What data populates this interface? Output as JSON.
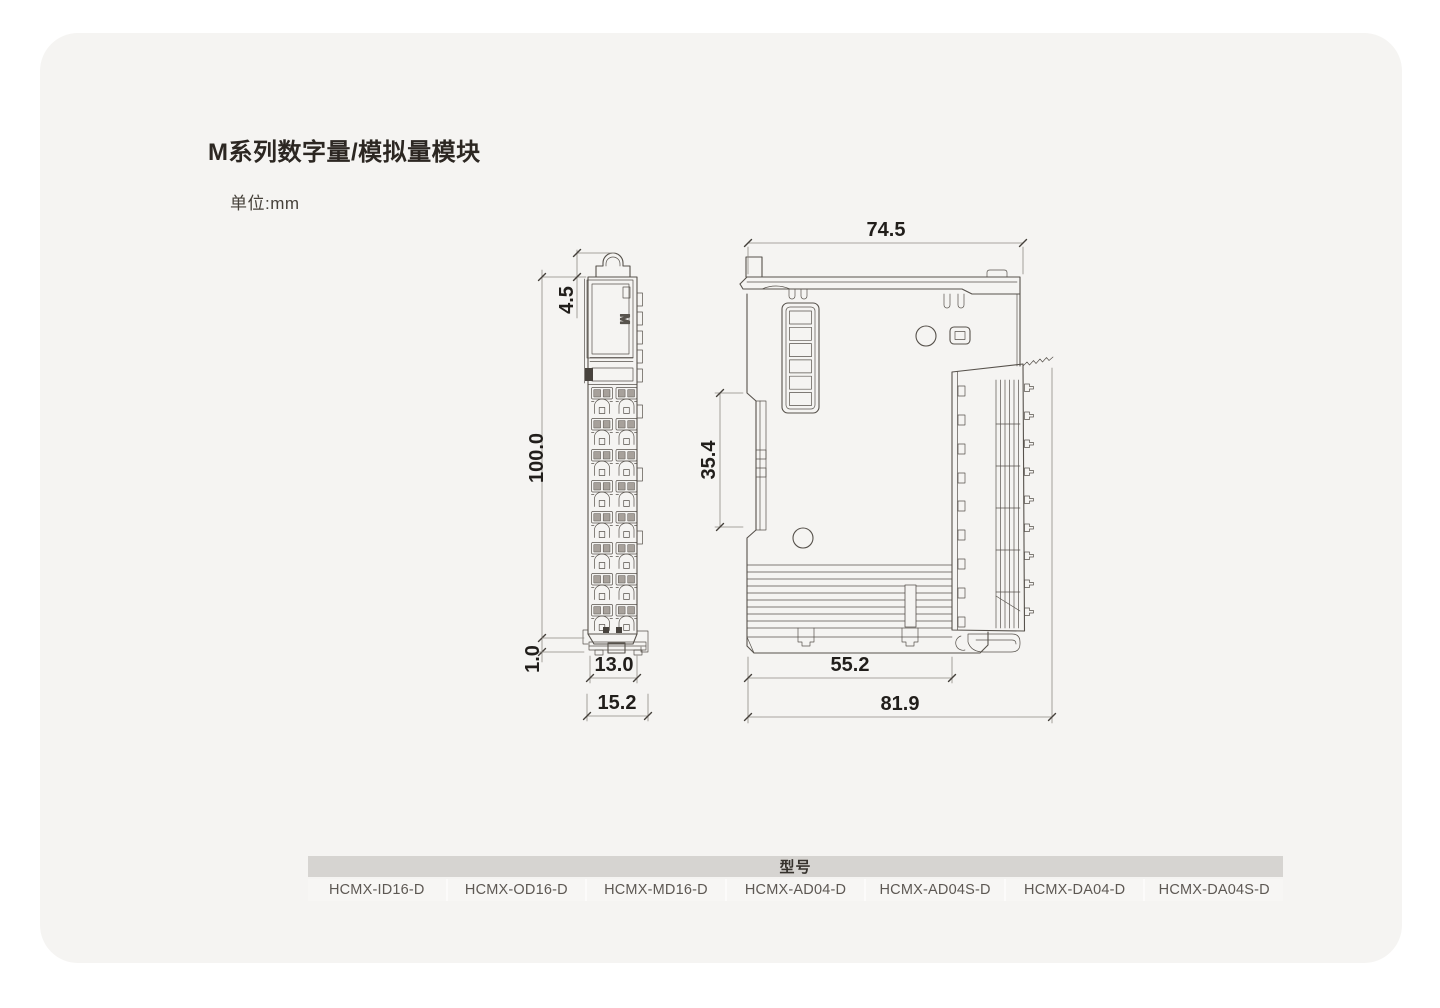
{
  "page": {
    "title": "M系列数字量/模拟量模块",
    "unit_label": "单位:mm"
  },
  "drawings": {
    "front_view": {
      "logo": "M",
      "terminal_rows": 8,
      "terminal_columns": 2,
      "dims": {
        "clip_height": "4.5",
        "body_height": "100.0",
        "foot_height": "1.0",
        "terminal_width": "13.0",
        "overall_width": "15.2"
      }
    },
    "side_view": {
      "dims": {
        "overall_depth_top": "74.5",
        "din_rail_height": "35.4",
        "lower_depth": "55.2",
        "overall_depth_bottom": "81.9"
      }
    }
  },
  "table": {
    "header": "型号",
    "models": [
      "HCMX-ID16-D",
      "HCMX-OD16-D",
      "HCMX-MD16-D",
      "HCMX-AD04-D",
      "HCMX-AD04S-D",
      "HCMX-DA04-D",
      "HCMX-DA04S-D"
    ]
  },
  "colors": {
    "card_bg": "#f5f4f2",
    "line": "#57524c",
    "dim_line": "#8f8a84",
    "dim_text": "#211e1b",
    "table_header_bg": "#d6d4d1",
    "table_cell_bg": "#f7f6f4"
  }
}
